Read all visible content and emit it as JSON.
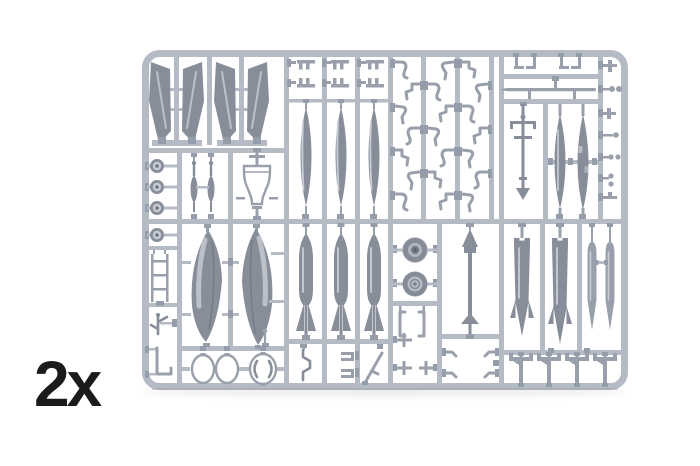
{
  "scene": {
    "subject": "injection-molded model kit parts sprue, light gray plastic on white background",
    "quantity_label": "2x"
  },
  "colors": {
    "background": "#ffffff",
    "runner": "#b5bbc5",
    "runner_gate": "#959caa",
    "part_medium": "#9aa0ab",
    "part_dark": "#878d99",
    "part_highlight": "#c9cdd5",
    "outline_part_stroke": "#99a0aa",
    "outline_part_fill": "#ffffff",
    "label_text": "#1b1b1b"
  },
  "sprue": {
    "part_groups": [
      {
        "id": "tail-fin-halves",
        "label": "vertical tail fin halves",
        "count": 4
      },
      {
        "id": "round-discs",
        "label": "small discs / hub wheels",
        "count": 4
      },
      {
        "id": "gun-strut-parts",
        "label": "slender gun / strut parts",
        "count": 2
      },
      {
        "id": "funnel-outline-part",
        "label": "hollow funnel-shaped part",
        "count": 1
      },
      {
        "id": "slender-blades",
        "label": "long slender blade parts",
        "count": 3
      },
      {
        "id": "bracket-clips",
        "label": "small comb bracket clips",
        "count": 6
      },
      {
        "id": "hook-levers",
        "label": "small hook and lever parts",
        "count": 21
      },
      {
        "id": "hanging-clips",
        "label": "small hanging clips",
        "count": 4
      },
      {
        "id": "long-rod",
        "label": "long thin rod",
        "count": 1
      },
      {
        "id": "antenna-mast",
        "label": "antenna / pitot mast",
        "count": 1
      },
      {
        "id": "narrow-blades",
        "label": "narrow vertical blades",
        "count": 2
      },
      {
        "id": "edge-fittings",
        "label": "small fittings on right edge",
        "count": 7
      },
      {
        "id": "drop-tank-halves",
        "label": "large drop tank halves",
        "count": 2
      },
      {
        "id": "ring-frames",
        "label": "oval ring frames",
        "count": 3
      },
      {
        "id": "bombs",
        "label": "finned bombs",
        "count": 3
      },
      {
        "id": "wheels",
        "label": "main wheels with hub detail",
        "count": 2
      },
      {
        "id": "dart-missile",
        "label": "arrow-shaped missile part",
        "count": 1
      },
      {
        "id": "finned-rockets",
        "label": "finned rocket bodies",
        "count": 2
      },
      {
        "id": "slim-missiles",
        "label": "slim missile bodies",
        "count": 2
      },
      {
        "id": "pylons",
        "label": "T-shaped pylon parts",
        "count": 4
      },
      {
        "id": "misc-small-parts",
        "label": "assorted small parts",
        "count": 14
      }
    ]
  }
}
